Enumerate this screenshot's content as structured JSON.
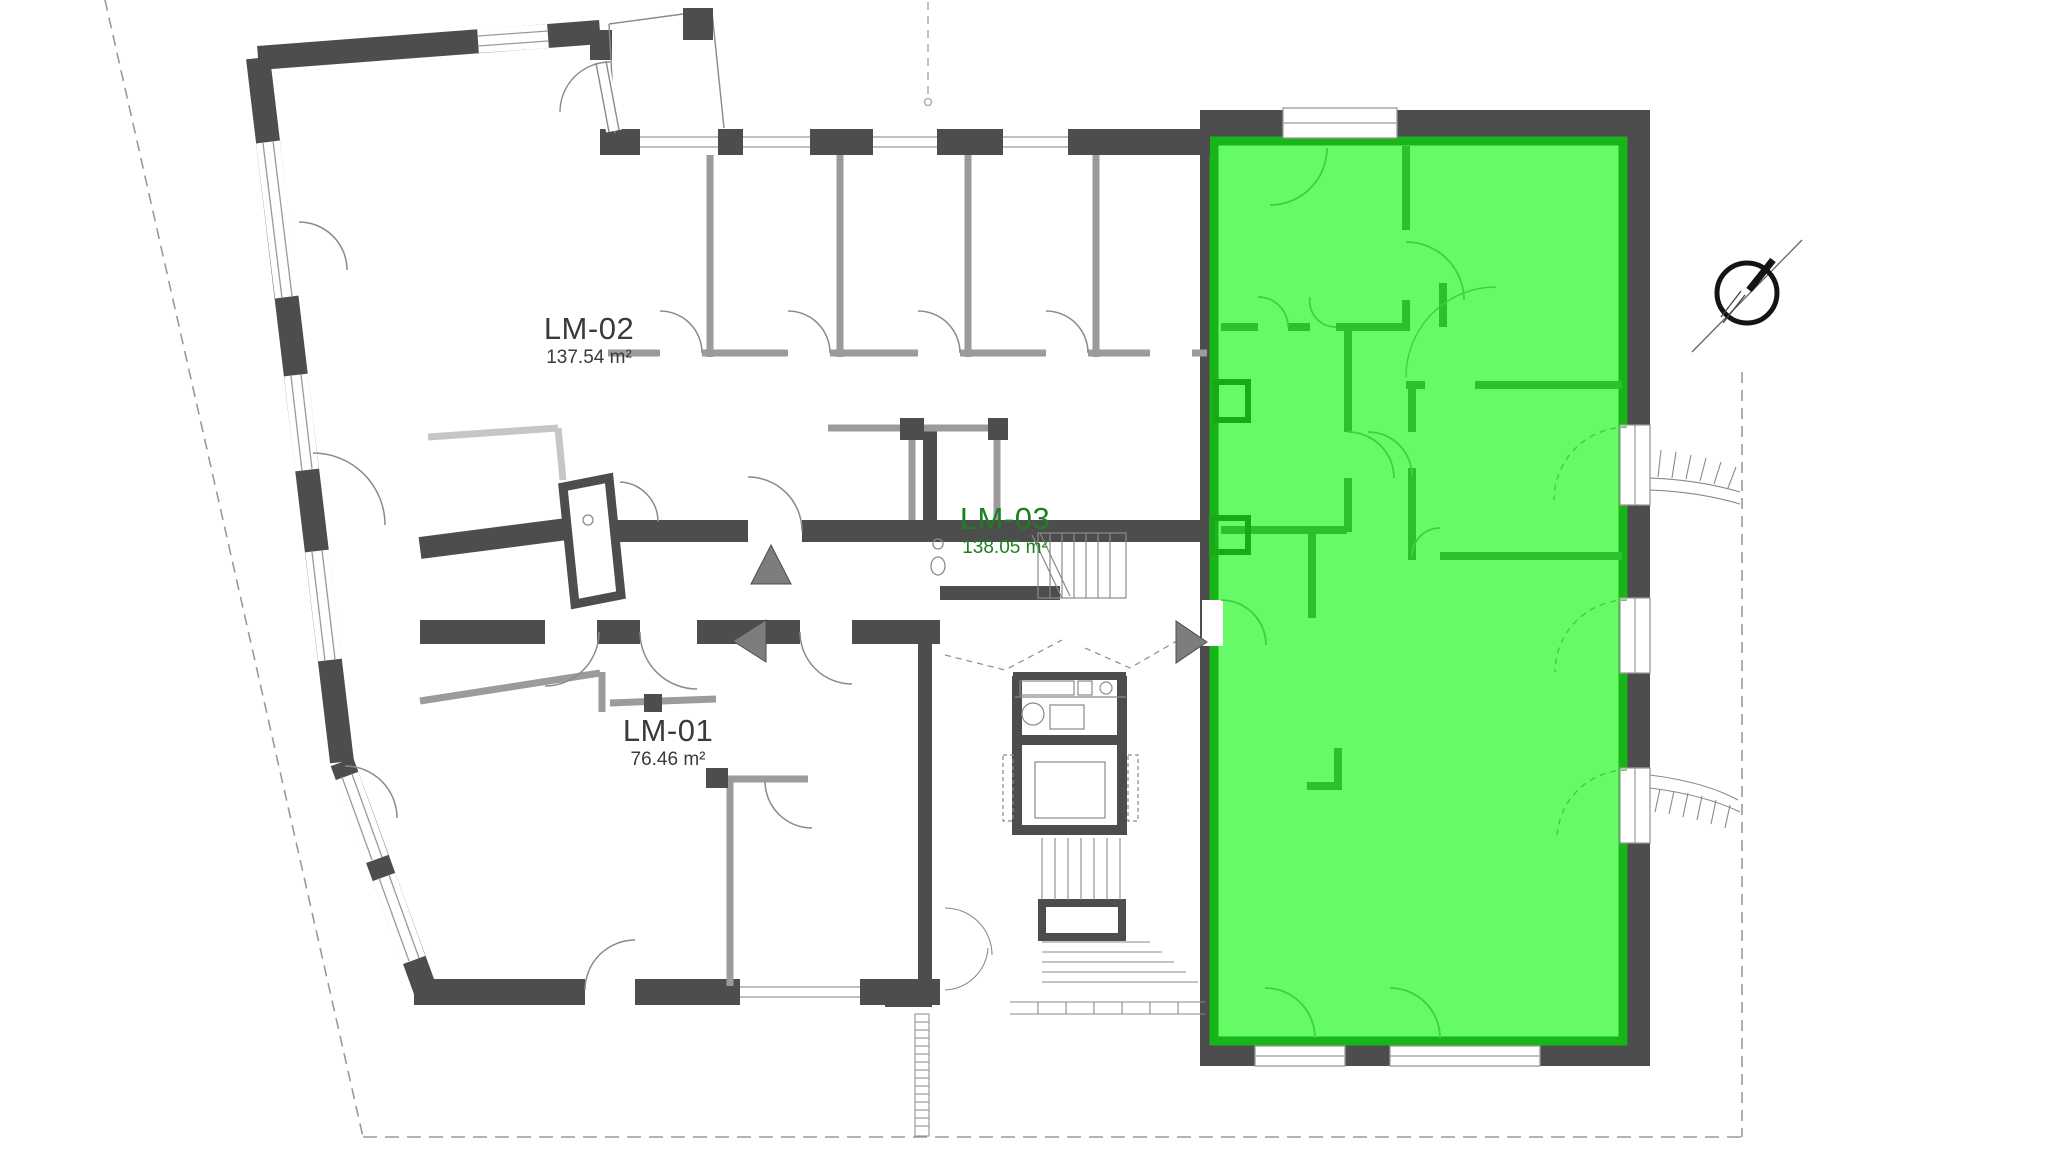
{
  "floorplan": {
    "type": "apartment-floor-plan",
    "units": [
      {
        "id": "lm-01",
        "label": "LM-01",
        "area": "76.46 m²",
        "highlighted": false
      },
      {
        "id": "lm-02",
        "label": "LM-02",
        "area": "137.54 m²",
        "highlighted": false
      },
      {
        "id": "lm-03",
        "label": "LM-03",
        "area": "138.05 m²",
        "highlighted": true
      }
    ],
    "colors": {
      "highlight_fill": "#66fb66",
      "highlight_border": "#17b517",
      "highlight_wall": "#2ebf2e",
      "exterior_wall": "#4d4d4d",
      "interior_wall": "#9b9b9b",
      "light_wall": "#c6c6c6",
      "thin_line": "#8a8a8a",
      "arrow_fill": "#7d7d7d",
      "label_text": "#3a3a3a",
      "highlight_label_text": "#1d7e22"
    },
    "markers": {
      "compass": "north-compass",
      "navigation_arrows": [
        "up",
        "left",
        "right"
      ]
    }
  }
}
